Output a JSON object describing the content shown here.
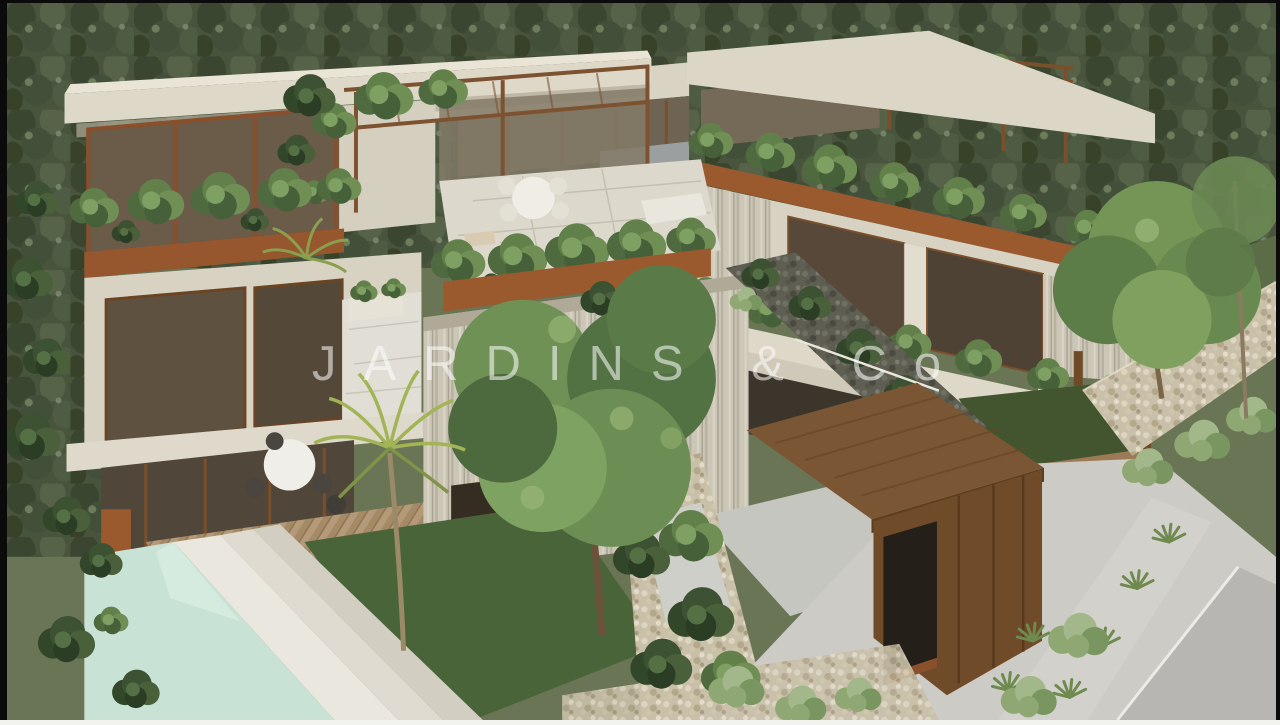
{
  "window": {
    "frame_color": "#0b0b0b",
    "bottom_strip_color": "#f2f2ef"
  },
  "watermark": {
    "text": "JARDINS & Co",
    "color": "#ffffff",
    "opacity": "0.55"
  },
  "scene": {
    "type": "3d-architectural-rendering",
    "subject": "Aerial view of a modern tropical villa complex with rooftop garden terraces, lush planters, a swimming pool, gabion stone walls, a timber entrance canopy and a forest backdrop",
    "elements": [
      "forest backdrop",
      "left villa with rooftop terrace and pergola",
      "right villa with stacked planter balconies",
      "rear villa roofline",
      "rooftop dining table",
      "cascading planter greenery",
      "board-formed concrete wall",
      "swimming pool with white coping",
      "timber pool deck",
      "palm trees",
      "large garden trees",
      "gabion stone walls",
      "timber entrance canopy and garage",
      "driveway and street with shrubs"
    ],
    "palette": {
      "concrete": "#d9d3c4",
      "board_form": "#ccc6b6",
      "timber": "#7b5634",
      "corten": "#9a5a2e",
      "glass": "#57483a",
      "foliage_dark": "#3c5232",
      "foliage_mid": "#628049",
      "foliage_light": "#8fa873",
      "lawn": "#4a643a",
      "pool_water": "#c8e3d6",
      "stone_wall": "#c9c0a9",
      "paving": "#cccbc5",
      "forest": "#49543d"
    }
  }
}
